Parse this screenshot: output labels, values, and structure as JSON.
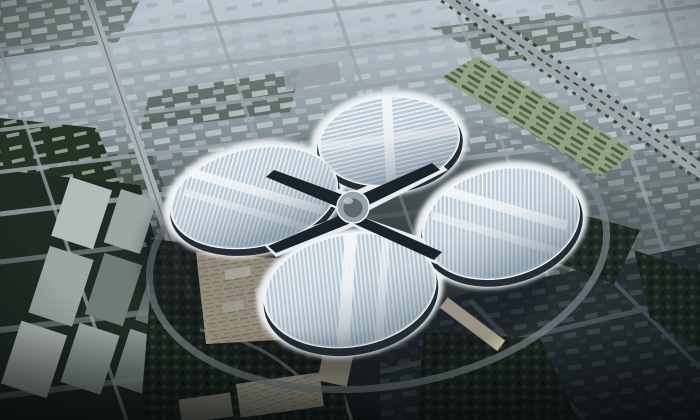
{
  "meta": {
    "title": "Aerial rendering of a four-petal clover-shaped exhibition complex",
    "description": "Bird's-eye architectural visualization: a vast white exhibition and convention center shaped like a four-leaf clover with a circular central hub, surrounded by hazy blue-grey city blocks, a tree-lined boulevard to the northeast, a landscaped parking strip, a wooded hill and industrial slabs to the west, parks and plazas to the south, and dark dense housing blocks to the southeast. No visible text in the image.",
    "visible_text": "none"
  },
  "scene": {
    "building": {
      "name": "clover-exhibition-center",
      "halls": [
        "north-hall",
        "east-hall",
        "south-hall",
        "west-hall"
      ],
      "hub": "central-circular-atrium",
      "roof_finish": "striped metal-and-glass panels with bright ridge bands",
      "base": "dark glazed facade ring with white ground-level apron"
    },
    "surroundings": [
      "hazy-city-grid-north",
      "tree-lined-boulevard-northeast",
      "landscaped-parking-strip-northeast",
      "green-hill-with-housing-rows-west",
      "industrial-slab-buildings-southwest",
      "left-expressway",
      "ring-road-around-venue",
      "west-entrance-plaza-beige",
      "east-pedestrian-bridge-beige",
      "central-park-south",
      "parking-lots-south",
      "dark-city-blocks-southeast"
    ]
  },
  "colors": {
    "sky_top": "#a7b6c1",
    "sky_upper": "#7d8c92",
    "city_mid": "#495552",
    "city_low": "#27302f",
    "ground_bottom": "#171d1f",
    "haze": "#ccdae4",
    "road_light": "#9aa4aa",
    "road_mid": "#707b80",
    "road_dark": "#4b565b",
    "expressway": "#a8b1b6",
    "block_light": "#bdc6ca",
    "block_light2": "#a9b3b8",
    "block_dark": "#3a464b",
    "block_darker": "#2c363b",
    "hill_green": "#243424",
    "green_mid": "#2d3f2b",
    "tree_base": "#1c2620",
    "tree_dot_dark": "#101a12",
    "tree_dot_light": "#2e4030",
    "parking_green": "#8fa383",
    "parking_row_green": "#3c5438",
    "slab_grey": "#9aa6a3",
    "slab_light": "#b3bcb9",
    "slab_dark": "#6e7c78",
    "plaza_beige": "#cfc5aa",
    "bridge_beige": "#d8cfb6",
    "lot_beige": "#b3ae9e",
    "roof_base": "#bccbd7",
    "roof_stripe": "#edf3f6",
    "roof_ridge": "#f7fafb",
    "facade_dark": "#222d35",
    "apron_white": "#e9eef1",
    "hub_top": "#97a3ad",
    "hub_core": "#5c6971",
    "seam_dark": "#19232a",
    "seam_white": "#e6ecef",
    "avenue_tree": "#2c3e2a",
    "shadow": "#0a0f12"
  }
}
